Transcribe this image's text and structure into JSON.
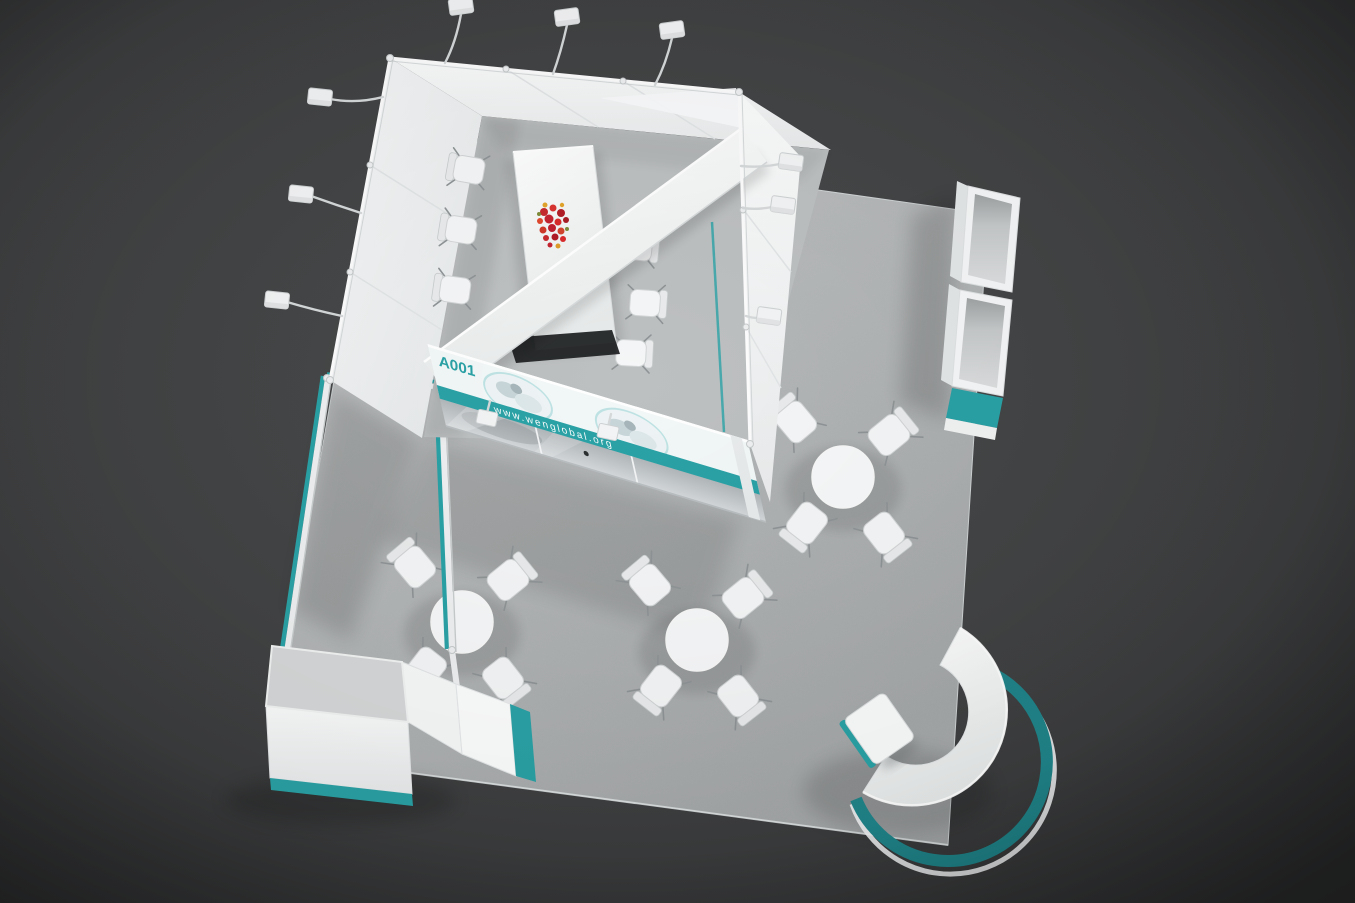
{
  "meta": {
    "title": "Exhibition stand 3D render - aerial view",
    "scene": "modular trade-show booth with meeting room, cafe tables, curved reception desk"
  },
  "palette": {
    "background_dark": "#343536",
    "background_center": "#4a4c4d",
    "carpet": "#b4b7b8",
    "wall_white": "#f5f6f7",
    "accent_teal": "#2aa2a6",
    "accent_teal_dark": "#1f8489",
    "glass_gray": "#b9bfc2",
    "flower_red": "#c42430",
    "flower_orange": "#e2a52c",
    "metal_gray": "#cfd3d4"
  },
  "banner": {
    "stand_number": "A001",
    "website": "www.wenglobal.org",
    "photo_count": 2
  },
  "objects": {
    "meeting_room": {
      "label": "enclosed meeting room",
      "chairs": 6,
      "decor": "red flower bouquet on conference table"
    },
    "open_area": {
      "round_tables": 3,
      "chairs_per_table": 4
    },
    "reception": {
      "label": "curved reception counter",
      "stools": 1
    },
    "kiosk": {
      "label": "corner counter with teal pergola frame"
    },
    "shelving": {
      "label": "open display cabinets",
      "units": 2
    },
    "lighting": {
      "arm_spotlights": 11
    }
  }
}
